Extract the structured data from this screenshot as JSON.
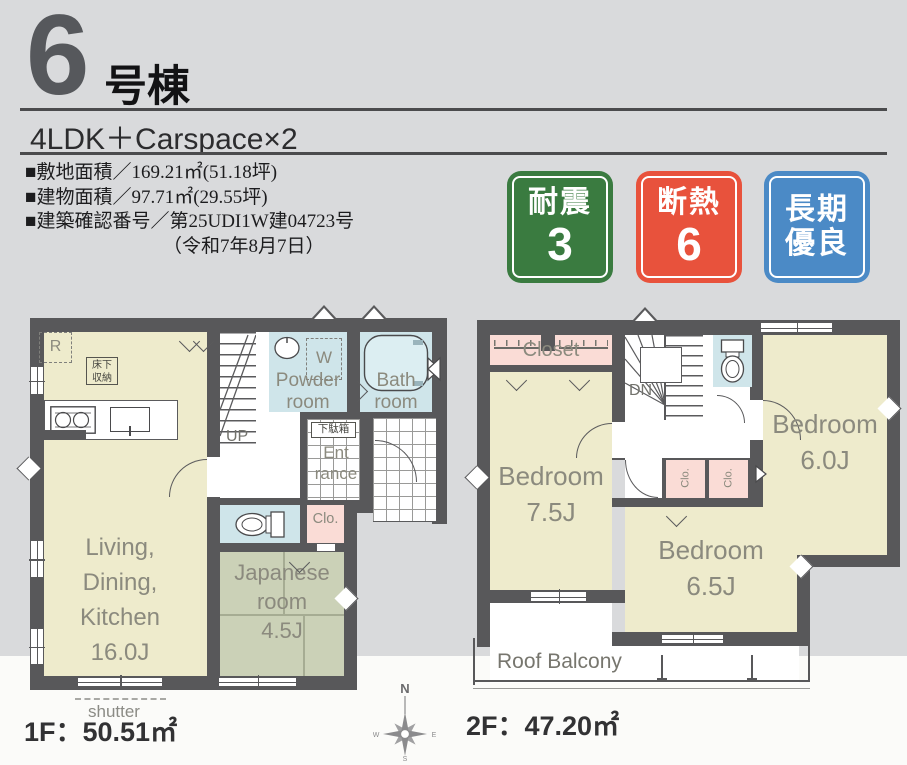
{
  "header": {
    "unit_number": "6",
    "unit_suffix": "号棟",
    "layout": "4LDK＋Carspace×2",
    "details": [
      "■敷地面積／169.21㎡(51.18坪)",
      "■建物面積／97.71㎡(29.55坪)",
      "■建築確認番号／第25UDI1W建04723号",
      "（令和7年8月7日）"
    ],
    "badges": [
      {
        "label": "耐震",
        "value": "3",
        "color": "#3a7b40"
      },
      {
        "label": "断熱",
        "value": "6",
        "color": "#e8523c"
      },
      {
        "label": "長期",
        "value": "優良",
        "color": "#4b8ac6"
      }
    ]
  },
  "colors": {
    "background": "#d9dadc",
    "wall": "#58585a",
    "room_cream": "#eeebcc",
    "wet_area_blue": "#cfe5ea",
    "closet_pink": "#fadcd6",
    "tatami_green": "#cbd1b7",
    "label_gray": "#8b8a7e"
  },
  "floor1": {
    "area_label": "1F：50.51㎡",
    "ldk": {
      "line1": "Living,",
      "line2": "Dining,",
      "line3": "Kitchen",
      "size": "16.0J"
    },
    "japanese": {
      "line1": "Japanese",
      "line2": "room",
      "size": "4.5J"
    },
    "powder": {
      "line1": "Powder",
      "line2": "room"
    },
    "bath": {
      "line1": "Bath",
      "line2": "room"
    },
    "entrance": {
      "line1": "Ent",
      "line2": "rance"
    },
    "closet": "Clo.",
    "shoe_box": "下駄箱",
    "underfloor": {
      "line1": "床下",
      "line2": "収納"
    },
    "fridge": "R",
    "washer": "W",
    "up": "UP",
    "shutter": "shutter"
  },
  "floor2": {
    "area_label": "2F：47.20㎡",
    "closet": "Closet",
    "dn": "DN",
    "bedroom1": {
      "name": "Bedroom",
      "size": "7.5J"
    },
    "bedroom2": {
      "name": "Bedroom",
      "size": "6.0J"
    },
    "bedroom3": {
      "name": "Bedroom",
      "size": "6.5J"
    },
    "clo1": "Clo.",
    "clo2": "Clo.",
    "balcony": "Roof Balcony"
  },
  "compass": {
    "n": "N",
    "w": "W",
    "e": "E",
    "s": "S"
  }
}
